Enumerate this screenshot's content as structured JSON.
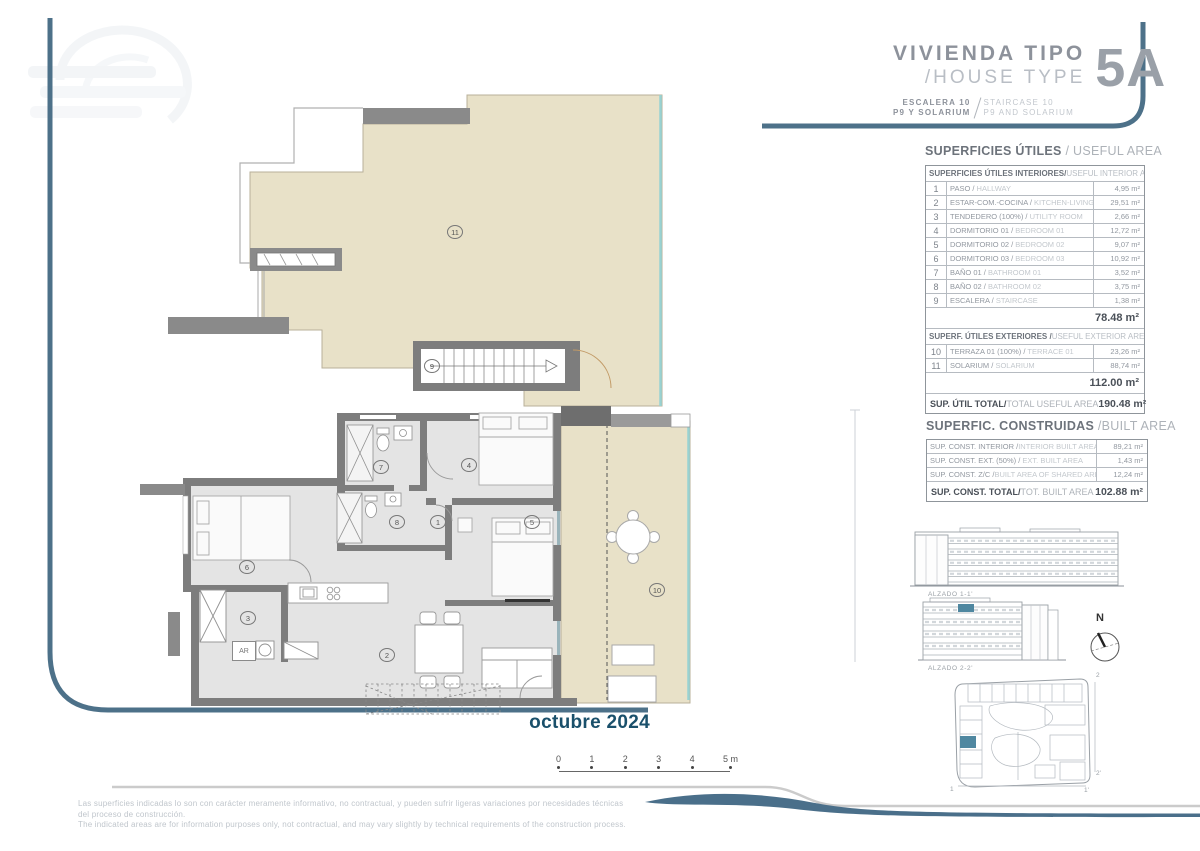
{
  "title_block": {
    "name_es": "VIVIENDA TIPO",
    "name_en": "/HOUSE TYPE",
    "code": "5A",
    "sub_left_1": "ESCALERA 10",
    "sub_left_2": "P9 Y SOLARIUM",
    "sub_right_1": "STAIRCASE 10",
    "sub_right_2": "P9 AND SOLARIUM"
  },
  "useful_area": {
    "title_es": "SUPERFICIES ÚTILES",
    "title_en": " / USEFUL AREA",
    "interior_header_es": "SUPERFICIES ÚTILES INTERIORES/",
    "interior_header_en": " USEFUL INTERIOR AREA",
    "interior_rows": [
      {
        "num": "1",
        "es": "PASO / ",
        "en": "HALLWAY",
        "area": "4,95 m²"
      },
      {
        "num": "2",
        "es": "ESTAR-COM.-COCINA / ",
        "en": "KITCHEN-LIVING",
        "area": "29,51 m²"
      },
      {
        "num": "3",
        "es": "TENDEDERO (100%) / ",
        "en": "UTILITY ROOM",
        "area": "2,66 m²"
      },
      {
        "num": "4",
        "es": "DORMITORIO 01 / ",
        "en": "BEDROOM 01",
        "area": "12,72 m²"
      },
      {
        "num": "5",
        "es": "DORMITORIO 02 / ",
        "en": "BEDROOM 02",
        "area": "9,07 m²"
      },
      {
        "num": "6",
        "es": "DORMITORIO 03 / ",
        "en": "BEDROOM 03",
        "area": "10,92 m²"
      },
      {
        "num": "7",
        "es": "BAÑO 01 / ",
        "en": "BATHROOM 01",
        "area": "3,52 m²"
      },
      {
        "num": "8",
        "es": "BAÑO 02 / ",
        "en": "BATHROOM 02",
        "area": "3,75 m²"
      },
      {
        "num": "9",
        "es": "ESCALERA / ",
        "en": "STAIRCASE",
        "area": "1,38 m²"
      }
    ],
    "interior_subtotal": "78.48 m²",
    "exterior_header_es": "SUPERF. ÚTILES EXTERIORES /",
    "exterior_header_en": " USEFUL EXTERIOR AREA",
    "exterior_rows": [
      {
        "num": "10",
        "es": "TERRAZA 01 (100%) / ",
        "en": "TERRACE 01",
        "area": "23,26 m²"
      },
      {
        "num": "11",
        "es": "SOLARIUM / ",
        "en": "SOLARIUM",
        "area": "88,74 m²"
      }
    ],
    "exterior_subtotal": "112.00 m²",
    "total_es": "SUP. ÚTIL TOTAL/",
    "total_en": "TOTAL USEFUL AREA",
    "total_value": "190.48 m²"
  },
  "built_area": {
    "title_es": "SUPERFIC. CONSTRUIDAS",
    "title_en": " /BUILT AREA",
    "rows": [
      {
        "es": "SUP. CONST. INTERIOR /",
        "en": "INTERIOR BUILT AREA",
        "area": "89,21 m²"
      },
      {
        "es": "SUP. CONST. EXT. (50%) / ",
        "en": "EXT. BUILT AREA",
        "area": "1,43 m²"
      },
      {
        "es": "SUP. CONST. Z/C /",
        "en": "BUILT AREA OF SHARED AREAS",
        "area": "12,24 m²"
      }
    ],
    "total_es": "SUP. CONST. TOTAL/",
    "total_en": "TOT. BUILT AREA",
    "total_value": "102.88 m²"
  },
  "plan": {
    "labels": {
      "r1": "1",
      "r2": "2",
      "r3": "3",
      "r4": "4",
      "r5": "5",
      "r6": "6",
      "r7": "7",
      "r8": "8",
      "r9": "9",
      "r10": "10",
      "r11": "11"
    },
    "appliance_label": "AR"
  },
  "elevations": {
    "label_1": "ALZADO 1-1'",
    "label_2": "ALZADO 2-2'"
  },
  "compass": {
    "north": "N"
  },
  "site_plan": {
    "mark_top_right": "2",
    "mark_right_bottom": "2'",
    "mark_bottom_left": "1",
    "mark_bottom_right": "1'"
  },
  "date_label": "octubre 2024",
  "scale_bar": {
    "ticks": [
      "0",
      "1",
      "2",
      "3",
      "4",
      "5 m"
    ]
  },
  "disclaimer": {
    "line1": "Las superficies indicadas lo son con carácter meramente informativo, no contractual, y pueden sufrir ligeras variaciones por necesidades técnicas",
    "line2": "del proceso de construcción.",
    "line3": "The indicated areas are for information purposes only, not contractual, and may vary slightly by technical requirements of the construction process."
  }
}
